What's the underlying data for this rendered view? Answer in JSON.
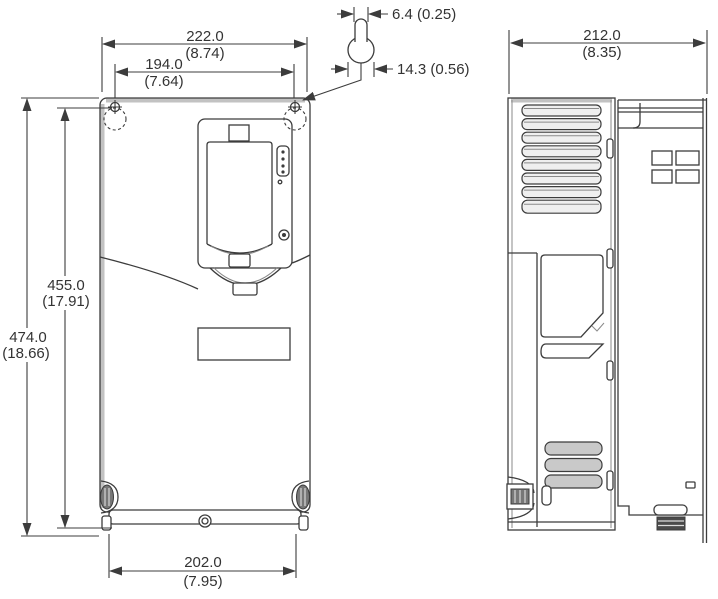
{
  "drawing": {
    "type": "mechanical-dimension-drawing",
    "views": {
      "front_view": "drive-front-outline",
      "side_view": "drive-side-outline",
      "detail": "mounting-keyhole-slot"
    },
    "colors": {
      "line": "#3c3c3c",
      "background": "#ffffff",
      "shading": "#c9c9c9"
    },
    "dims": {
      "overall_width": {
        "mm": "222.0",
        "in": "(8.74)"
      },
      "mounting_width": {
        "mm": "194.0",
        "in": "(7.64)"
      },
      "slot_width": {
        "value": "6.4 (0.25)"
      },
      "hole_diameter": {
        "value": "14.3 (0.56)"
      },
      "mounting_height": {
        "mm": "455.0",
        "in": "(17.91)"
      },
      "overall_height": {
        "mm": "474.0",
        "in": "(18.66)"
      },
      "bottom_width": {
        "mm": "202.0",
        "in": "(7.95)"
      },
      "depth": {
        "mm": "212.0",
        "in": "(8.35)"
      }
    }
  }
}
